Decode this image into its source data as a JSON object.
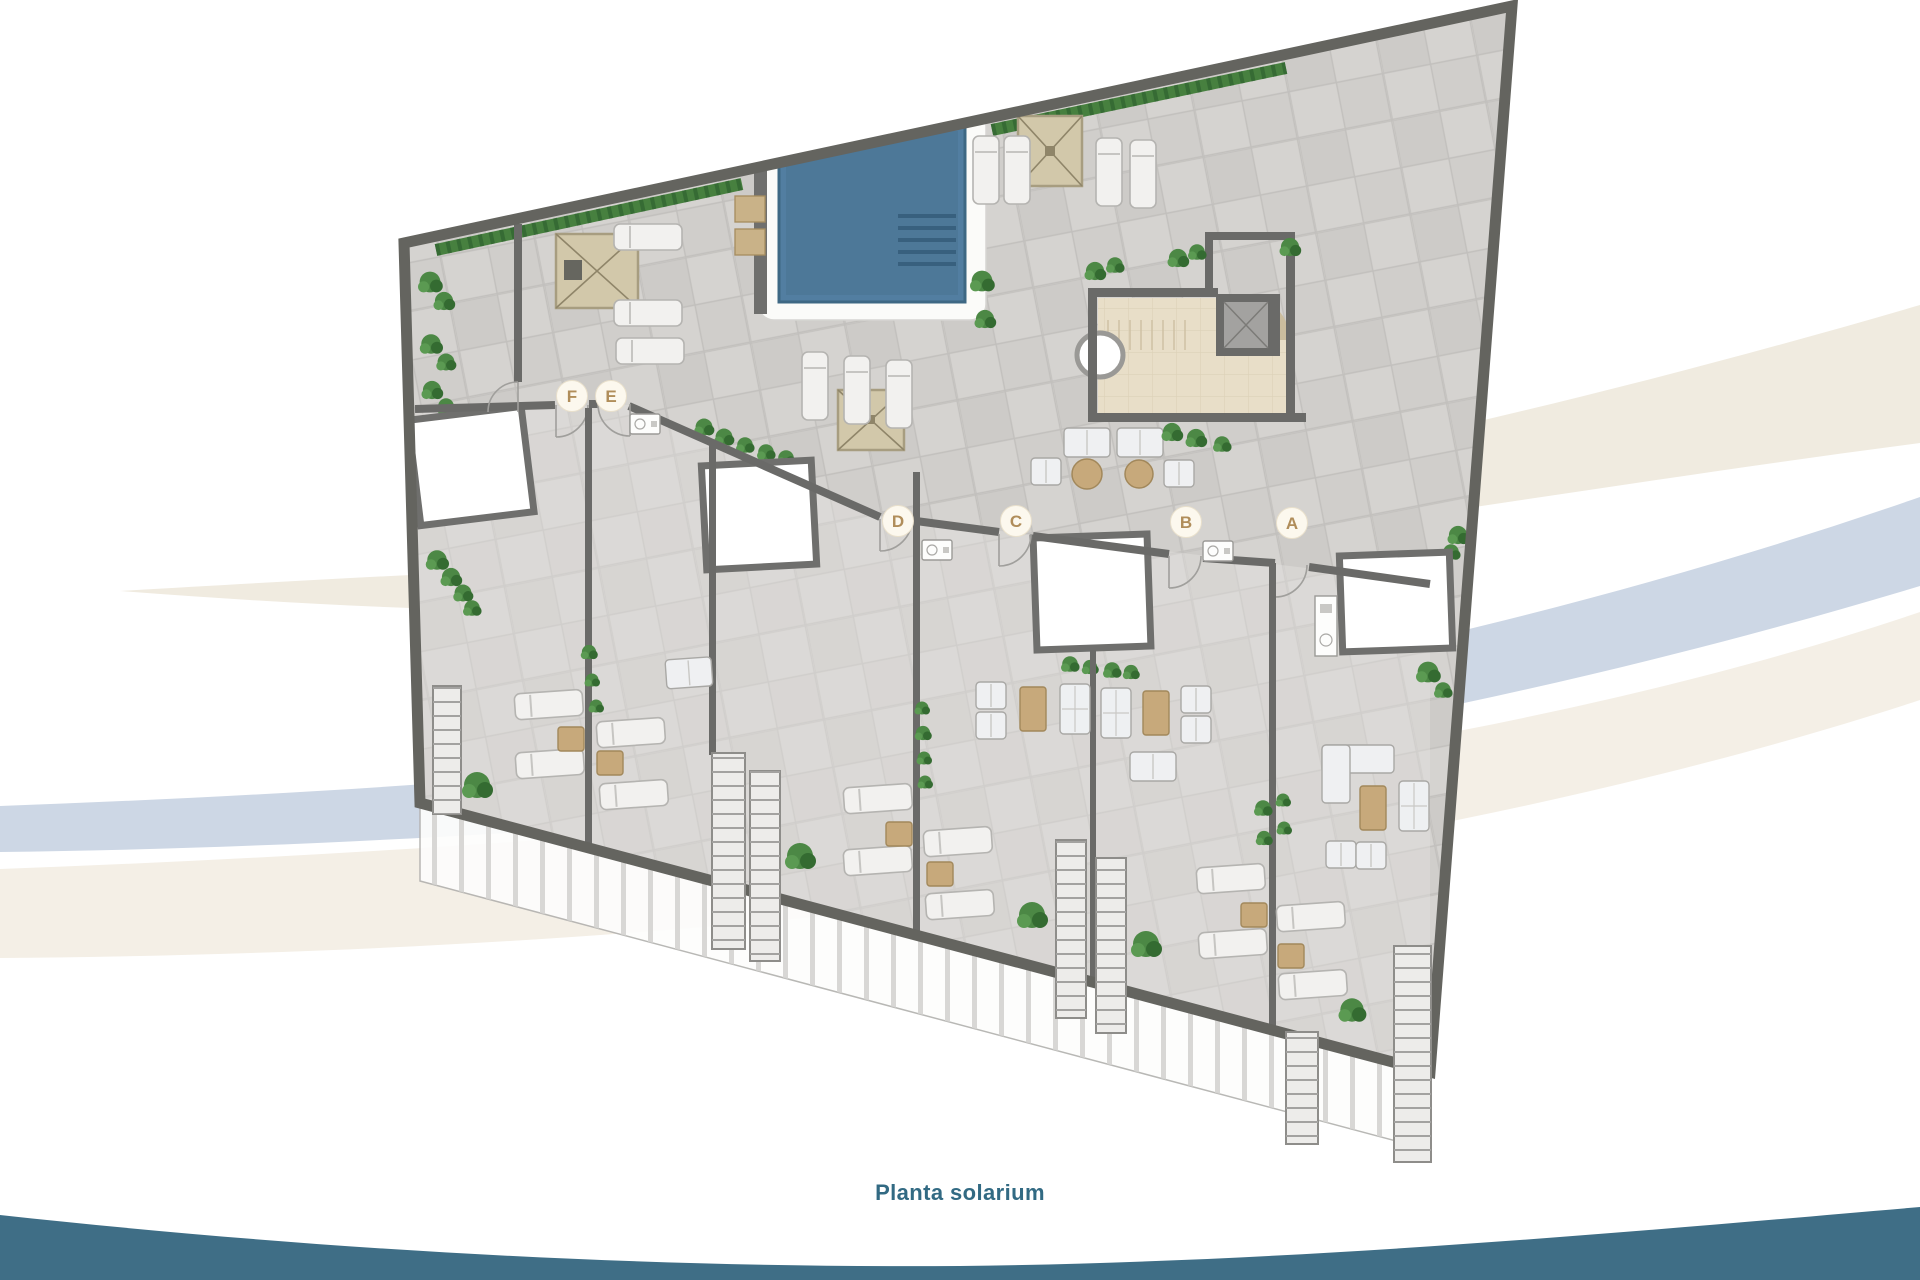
{
  "caption": {
    "text": "Planta solarium"
  },
  "plan": {
    "name": "solarium-roof-terrace-floor-plan",
    "units": [
      {
        "id": "f",
        "label": "F"
      },
      {
        "id": "e",
        "label": "E"
      },
      {
        "id": "d",
        "label": "D"
      },
      {
        "id": "c",
        "label": "C"
      },
      {
        "id": "b",
        "label": "B"
      },
      {
        "id": "a",
        "label": "A"
      }
    ],
    "marker": {
      "bg": "#fcf8ee",
      "border": "#e9e0cc",
      "letter_color": "#b08d5a"
    },
    "icons": [
      "swimming-pool-icon",
      "pergola-icon",
      "sun-lounger-icon",
      "plant-icon",
      "stairs-icon",
      "elevator-icon",
      "outdoor-bar-icon",
      "glass-railing-icon",
      "door-swing-icon",
      "sink-icon"
    ]
  },
  "colors": {
    "walls": "#64645f",
    "tiles": "#d4d2cf",
    "pool_water": "#527ea1",
    "pool_deck": "#fbfbf9",
    "pergola": "#d2c8aa",
    "furniture_tan": "#c7a97b",
    "plants": "#4c8845",
    "caption_text": "#326a83",
    "bottom_wave": "#3f6e86",
    "swoosh_blue": "#cdd7e5",
    "swoosh_beige": "#f0ebe0",
    "swoosh_beige_light": "#f4efe6"
  }
}
